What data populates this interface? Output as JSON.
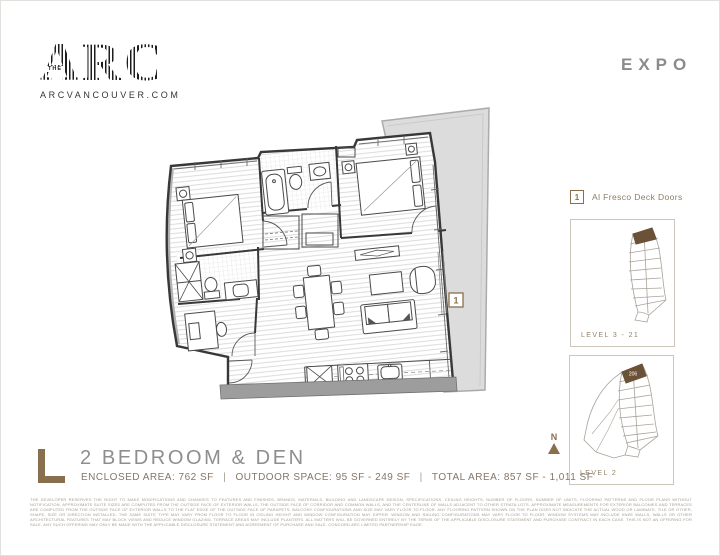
{
  "page": {
    "accent_color": "#8a6f4f",
    "title_color": "#8e8e8e"
  },
  "header": {
    "logo": {
      "pre": "THE",
      "name": "ARC",
      "website": "ARCVANCOUVER.COM"
    },
    "series": "EXPO"
  },
  "floorplan": {
    "marker_label": "1"
  },
  "legend": {
    "marker": "1",
    "label": "Al Fresco Deck Doors"
  },
  "keyplans": [
    {
      "label": "LEVEL 3 - 21"
    },
    {
      "label": "LEVEL 2",
      "highlighted_unit": "206"
    }
  ],
  "compass": {
    "label": "N"
  },
  "unit": {
    "plan_letter": "L",
    "title": "2 BEDROOM & DEN",
    "separator": "|",
    "stats": [
      {
        "label": "ENCLOSED AREA:",
        "value": "762 SF"
      },
      {
        "label": "OUTDOOR SPACE:",
        "value": "95 SF - 249 SF"
      },
      {
        "label": "TOTAL AREA:",
        "value": "857 SF - 1,011 SF"
      }
    ]
  },
  "disclaimer": {
    "text": "THE DEVELOPER RESERVES THE RIGHT TO MAKE MODIFICATIONS AND CHANGES TO FEATURES AND FINISHES, BRANDS, MATERIALS, BUILDING AND LANDSCAPE DESIGN, SPECIFICATIONS, CEILING HEIGHTS, NUMBER OF FLOORS, NUMBER OF UNITS, FLOORING PATTERNS AND FLOOR PLANS WITHOUT NOTIFICATION. APPROXIMATE SUITE SIZES ARE COMPUTED FROM THE OUTSIDE FACE OF EXTERIOR WALLS, THE OUTSIDE FACE OF CORRIDOR AND COMMON WALLS, AND THE CENTERLINE OF WALLS ADJACENT TO OTHER STRATA LOTS. APPROXIMATE MEASUREMENTS FOR EXTERIOR BALCONIES AND TERRACES ARE COMPUTED FROM THE OUTSIDE FACE OF EXTERIOR WALLS TO THE FLAT EDGE OF THE OUTSIDE FACE OF PARAPETS. BALCONY CONFIGURATIONS AND SIZE MAY VARY FLOOR TO FLOOR. ANY FLOORING PATTERN SHOWN ON THE PLAN DOES NOT INDICATE THE ACTUAL WOOD OR LAMINATE, TILE OR OTHER, SHAPE, SIZE OR DIRECTION INSTALLED. THE SAME SUITE TYPE MAY VARY FROM FLOOR TO FLOOR IN CEILING HEIGHT AND WINDOW CONFIGURATION MAY DIFFER. WINDOW AND RAILING CONFIGURATIONS MAY VARY FLOOR TO FLOOR. WINDOW SYSTEMS MAY INCLUDE KNEE WALLS, WALLS OR OTHER ARCHITECTURAL FEATURES THAT MAY BLOCK VIEWS AND REDUCE WINDOW GLAZING. TERRACE AREAS MAY INCLUDE PLANTERS. ALL MATTERS WILL BE GOVERNED ENTIRELY BY THE TERMS OF THE APPLICABLE DISCLOSURE STATEMENT AND PURCHASE CONTRACT IN EACH CASE. THIS IS NOT AN OFFERING FOR SALE. ANY SUCH OFFERING MAY ONLY BE MADE WITH THE APPLICABLE DISCLOSURE STATEMENT AND AGREEMENT OF PURCHASE AND SALE. CONCORD ARC LIMITED PARTNERSHIP E&OE."
  }
}
